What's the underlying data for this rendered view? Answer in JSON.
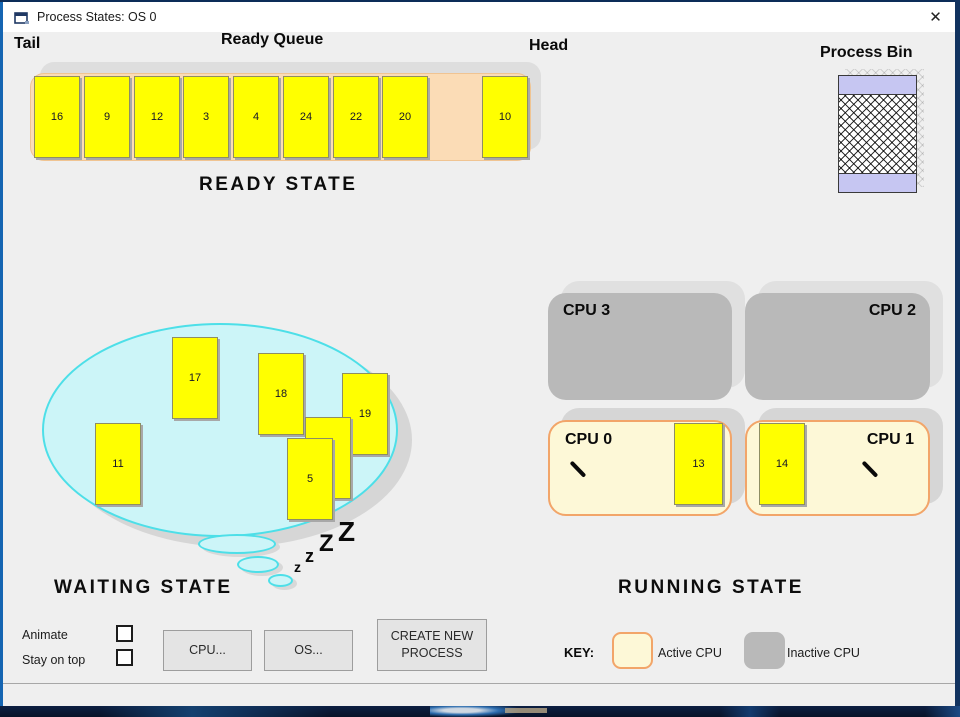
{
  "window": {
    "title": "Process States: OS 0",
    "close_glyph": "✕"
  },
  "ready": {
    "tail_label": "Tail",
    "queue_label": "Ready Queue",
    "head_label": "Head",
    "state_label": "READY STATE",
    "slots": [
      "16",
      "9",
      "12",
      "3",
      "4",
      "24",
      "22",
      "20",
      "",
      "10"
    ]
  },
  "bin": {
    "label": "Process Bin"
  },
  "waiting": {
    "state_label": "WAITING STATE",
    "cards": {
      "c17": "17",
      "c18": "18",
      "c19": "19",
      "hidden": "",
      "c5": "5",
      "c11": "11"
    },
    "sleep": {
      "z1": "z",
      "z2": "z",
      "z3": "Z",
      "z4": "Z"
    }
  },
  "running": {
    "state_label": "RUNNING STATE",
    "cpu3": {
      "label": "CPU 3"
    },
    "cpu2": {
      "label": "CPU 2"
    },
    "cpu0": {
      "label": "CPU 0",
      "process": "13"
    },
    "cpu1": {
      "label": "CPU 1",
      "process": "14"
    }
  },
  "key": {
    "label": "KEY:",
    "active": "Active CPU",
    "inactive": "Inactive CPU"
  },
  "controls": {
    "animate": "Animate",
    "stay_on_top": "Stay on top",
    "cpu_button": "CPU...",
    "os_button": "OS...",
    "create_button": "CREATE NEW PROCESS"
  },
  "colors": {
    "card_yellow": "#ffff00",
    "queue_peach": "#fbdcb6",
    "active_cpu_fill": "#fdf8d7",
    "active_cpu_border": "#f2a569",
    "inactive_cpu": "#b9b9b9",
    "bubble_fill": "#ccf5f8",
    "bubble_border": "#4ddfe8",
    "bin_lavender": "#c6c6f2"
  }
}
